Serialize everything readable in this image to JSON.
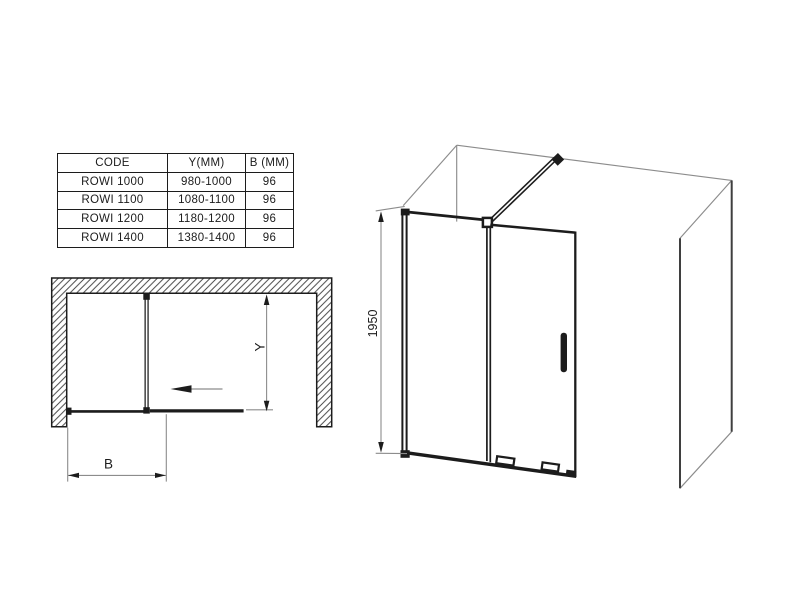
{
  "colors": {
    "ink": "#1c1c1c",
    "dim_line": "#8c8c8c",
    "wall_edge": "#3f3f3f",
    "background": "#ffffff"
  },
  "spec_table": {
    "headers": [
      "CODE",
      "Y(MM)",
      "B (MM)"
    ],
    "rows": [
      {
        "code": "ROWI 1000",
        "y_mm": "980-1000",
        "b_mm": "96"
      },
      {
        "code": "ROWI 1100",
        "y_mm": "1080-1100",
        "b_mm": "96"
      },
      {
        "code": "ROWI 1200",
        "y_mm": "1180-1200",
        "b_mm": "96"
      },
      {
        "code": "ROWI 1400",
        "y_mm": "1380-1400",
        "b_mm": "96"
      }
    ]
  },
  "plan_view": {
    "y_label": "Y",
    "b_label": "B"
  },
  "isometric_view": {
    "height_label": "1950"
  }
}
